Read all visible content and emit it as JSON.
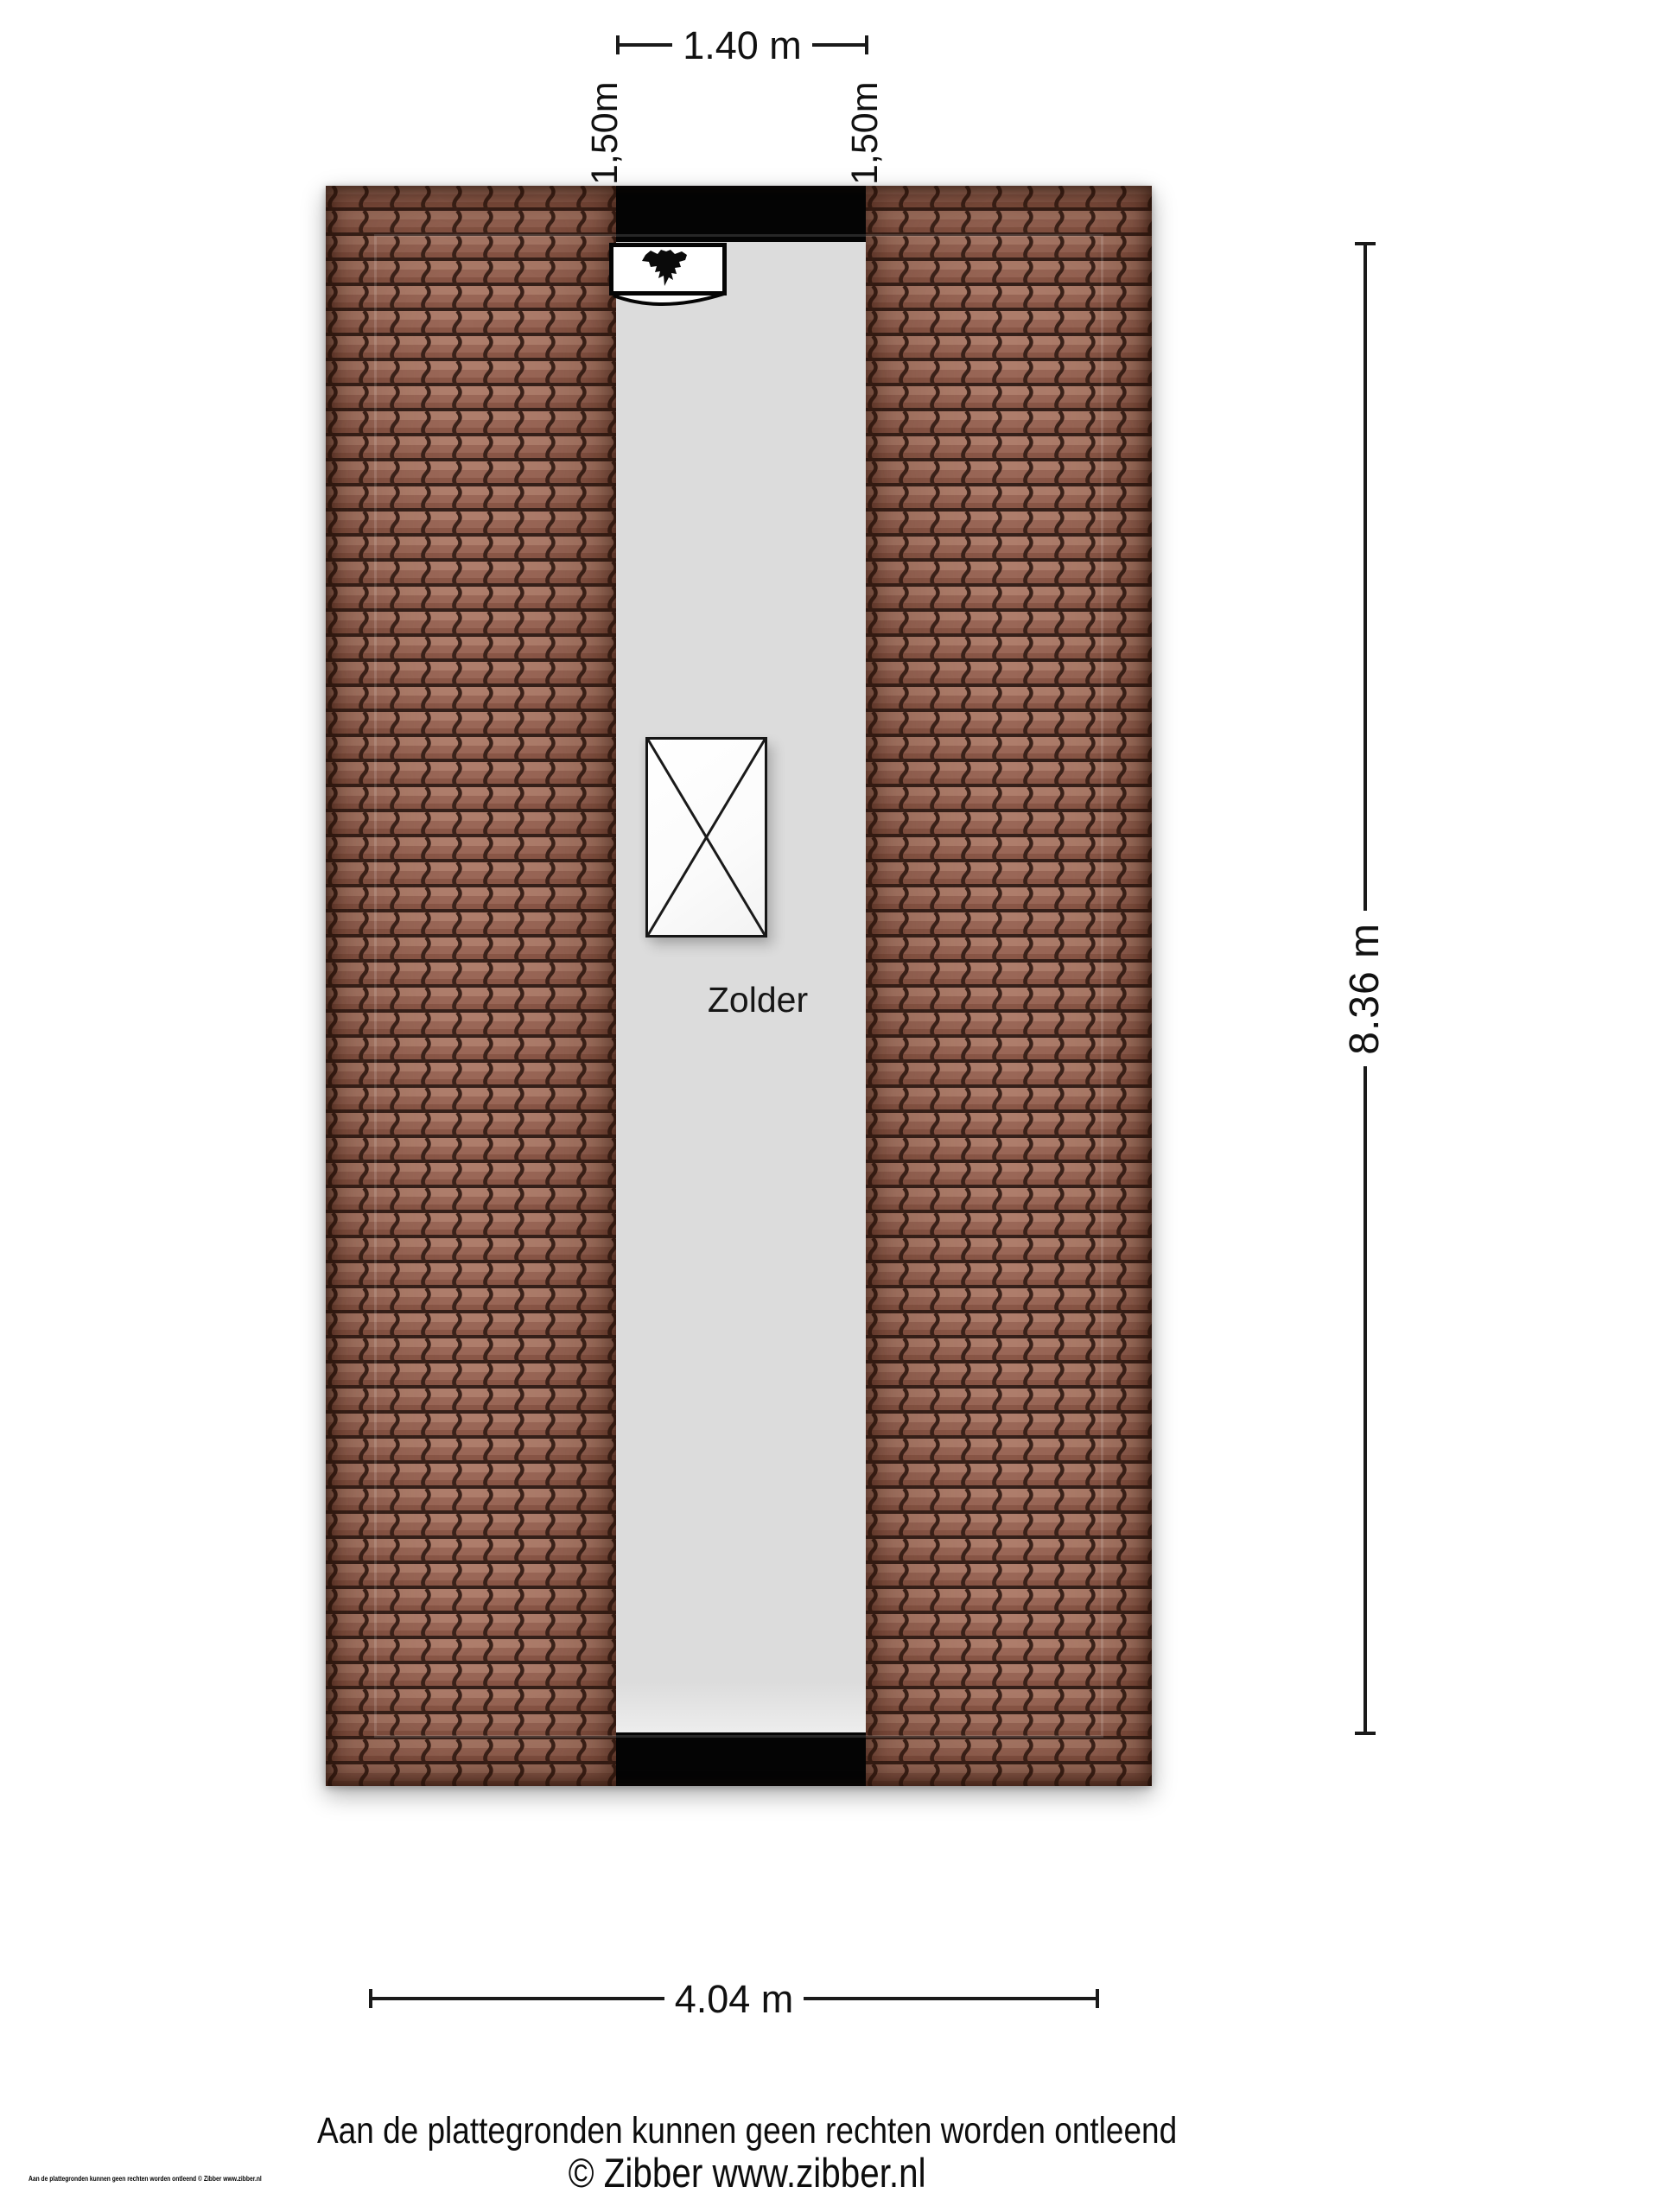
{
  "floorplan": {
    "room_label": "Zolder",
    "symbols": {
      "fireplace": "flame-icon",
      "floor_opening": "x-cross"
    },
    "colors": {
      "roof_tile": "#9e6a5a",
      "roof_tile_highlight": "#ae7d6b",
      "roof_tile_gap": "#35201a",
      "floor": "#dcdcdc",
      "wall": "#040404"
    }
  },
  "dimensions": {
    "corridor_width_top": "1.40 m",
    "headroom_left": "1,50m",
    "headroom_right": "1,50m",
    "depth_right": "8.36 m",
    "width_bottom": "4.04 m"
  },
  "footer": {
    "disclaimer": "Aan de plattegronden kunnen geen rechten worden ontleend",
    "copyright": "© Zibber www.zibber.nl",
    "small_print": "Aan de plattegronden kunnen geen rechten worden ontleend © Zibber www.zibber.nl"
  }
}
